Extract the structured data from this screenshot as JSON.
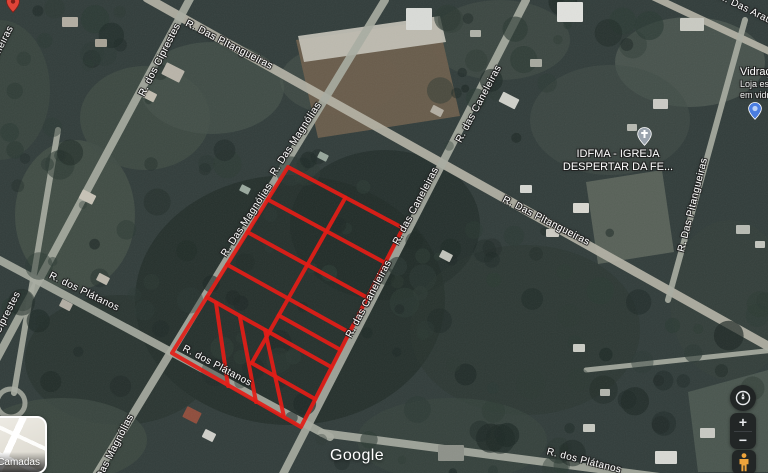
{
  "colors": {
    "parcel_stroke": "#e41d17",
    "road_fill": "#a9ada2",
    "road_fill_light": "#b7b5a8",
    "label_text": "#ffffff",
    "church_pin": "#9aa3ad",
    "store_pin": "#4a7de0",
    "red_marker": "#e04438",
    "pegman": "#eda33b",
    "control_bg": "#1b1d1f"
  },
  "map": {
    "attribution": "Google",
    "road_labels": [
      {
        "text": "R. dos Ciprestes",
        "x": 160,
        "y": 60,
        "rot": -63
      },
      {
        "text": "R. Das Pitangueiras",
        "x": 229,
        "y": 45,
        "rot": 27
      },
      {
        "text": "R. Das Magnólias",
        "x": 296,
        "y": 139,
        "rot": -57
      },
      {
        "text": "R. Das Magnólias",
        "x": 247,
        "y": 220,
        "rot": -57
      },
      {
        "text": "R. das Caneleiras",
        "x": 479,
        "y": 104,
        "rot": -62
      },
      {
        "text": "R. das Caneleiras",
        "x": 416,
        "y": 206,
        "rot": -62
      },
      {
        "text": "R. das Caneleiras",
        "x": 369,
        "y": 299,
        "rot": -62
      },
      {
        "text": "R. Das Pitangueiras",
        "x": 546,
        "y": 221,
        "rot": 27
      },
      {
        "text": "R. Das Pitangueiras",
        "x": 693,
        "y": 205,
        "rot": -76
      },
      {
        "text": "R. Das Araucárias",
        "x": 758,
        "y": 15,
        "rot": 26
      },
      {
        "text": "R. dos Plátanos",
        "x": 84,
        "y": 292,
        "rot": 26
      },
      {
        "text": "R. dos Plátanos",
        "x": 217,
        "y": 366,
        "rot": 28
      },
      {
        "text": "R. dos Plátanos",
        "x": 584,
        "y": 461,
        "rot": 14
      },
      {
        "text": "R. dos Ciprestes",
        "x": 0,
        "y": 328,
        "rot": -63
      },
      {
        "text": "R. Das Magnólias",
        "x": 112,
        "y": 453,
        "rot": -63
      },
      {
        "text": "R. Das Palmeiras",
        "x": -8,
        "y": 64,
        "rot": -63
      }
    ],
    "pois": {
      "church": {
        "line1": "IDFMA - IGREJA",
        "line2": "DESPERTAR DA FE...",
        "text_x": 533,
        "text_y": 148,
        "icon_x": 637,
        "icon_y": 127
      },
      "store": {
        "line1": "Vidraçar",
        "line2": "Loja espe",
        "line3": "em vidro",
        "text_x": 740,
        "text_y": 66,
        "icon_x": 748,
        "icon_y": 102
      }
    },
    "red_marker": {
      "x": 6,
      "y": -5
    },
    "roads": [
      {
        "x1": 147,
        "y1": -2,
        "x2": 775,
        "y2": 350,
        "w": 9,
        "light": true
      },
      {
        "x1": 192,
        "y1": -5,
        "x2": -12,
        "y2": 375,
        "w": 8,
        "light": false
      },
      {
        "x1": 385,
        "y1": 0,
        "x2": 90,
        "y2": 485,
        "w": 8,
        "light": false
      },
      {
        "x1": 526,
        "y1": 0,
        "x2": 280,
        "y2": 480,
        "w": 8,
        "light": false
      },
      {
        "x1": -10,
        "y1": 255,
        "x2": 330,
        "y2": 437,
        "w": 8,
        "light": false
      },
      {
        "x1": 322,
        "y1": 433,
        "x2": 775,
        "y2": 492,
        "w": 8,
        "light": false
      },
      {
        "x1": 628,
        "y1": -15,
        "x2": 792,
        "y2": 62,
        "w": 7,
        "light": true
      },
      {
        "x1": 745,
        "y1": 20,
        "x2": 668,
        "y2": 300,
        "w": 6,
        "light": false
      },
      {
        "x1": 586,
        "y1": 370,
        "x2": 775,
        "y2": 350,
        "w": 5,
        "light": false
      },
      {
        "x1": 58,
        "y1": 130,
        "x2": 14,
        "y2": 393,
        "w": 6,
        "light": false
      }
    ],
    "culdesac": {
      "cx": 11,
      "cy": 403,
      "r": 14
    },
    "terrain": {
      "polygons": [
        {
          "pts": [
            [
              296,
              40
            ],
            [
              438,
              20
            ],
            [
              460,
              116
            ],
            [
              318,
              138
            ]
          ],
          "fill": "#6b5e4c",
          "op": 0.95
        },
        {
          "pts": [
            [
              298,
              36
            ],
            [
              440,
              16
            ],
            [
              446,
              42
            ],
            [
              304,
              62
            ]
          ],
          "fill": "#c6c4ba",
          "op": 0.9
        },
        {
          "pts": [
            [
              586,
              182
            ],
            [
              662,
              170
            ],
            [
              674,
              252
            ],
            [
              598,
              264
            ]
          ],
          "fill": "#5c655c",
          "op": 0.9
        },
        {
          "pts": [
            [
              688,
              392
            ],
            [
              768,
              370
            ],
            [
              768,
              472
            ],
            [
              698,
              472
            ]
          ],
          "fill": "#4d5952",
          "op": 0.9
        }
      ],
      "ellipses": [
        [
          290,
          300,
          155,
          125,
          "#232e2b",
          0.8
        ],
        [
          385,
          225,
          95,
          75,
          "#202b28",
          0.65
        ],
        [
          120,
          360,
          95,
          65,
          "#27322d",
          0.6
        ],
        [
          525,
          330,
          115,
          85,
          "#2a3530",
          0.5
        ],
        [
          75,
          215,
          60,
          75,
          "#47534a",
          0.75
        ],
        [
          145,
          118,
          65,
          52,
          "#404c45",
          0.8
        ],
        [
          212,
          88,
          72,
          46,
          "#46524b",
          0.7
        ],
        [
          690,
          62,
          75,
          45,
          "#4d5952",
          0.8
        ],
        [
          62,
          440,
          85,
          42,
          "#3d4a42",
          0.8
        ],
        [
          452,
          440,
          95,
          42,
          "#38443e",
          0.7
        ],
        [
          610,
          120,
          80,
          55,
          "#414d47",
          0.6
        ],
        [
          730,
          300,
          60,
          80,
          "#35413c",
          0.6
        ],
        [
          340,
          80,
          60,
          35,
          "#4a564e",
          0.5
        ],
        [
          500,
          40,
          70,
          40,
          "#434f48",
          0.6
        ],
        [
          0,
          90,
          50,
          70,
          "#3c4841",
          0.7
        ]
      ],
      "buildings": [
        [
          406,
          8,
          26,
          22,
          0,
          "#d9dbd7"
        ],
        [
          557,
          2,
          26,
          20,
          0,
          "#e0e1dd"
        ],
        [
          163,
          66,
          20,
          13,
          27,
          "#b9b4a9"
        ],
        [
          143,
          91,
          13,
          9,
          27,
          "#c2bdb0"
        ],
        [
          500,
          95,
          18,
          11,
          27,
          "#cfd0c9"
        ],
        [
          431,
          107,
          12,
          8,
          27,
          "#b3aea2"
        ],
        [
          520,
          185,
          12,
          8,
          0,
          "#d5d6d1"
        ],
        [
          573,
          203,
          16,
          10,
          0,
          "#d9d8d1"
        ],
        [
          546,
          229,
          13,
          8,
          0,
          "#ceccc4"
        ],
        [
          80,
          192,
          15,
          10,
          27,
          "#c7c2b6"
        ],
        [
          97,
          275,
          12,
          8,
          27,
          "#bcb7ab"
        ],
        [
          60,
          301,
          12,
          8,
          27,
          "#b3aea4"
        ],
        [
          184,
          409,
          16,
          12,
          27,
          "#8f4d3c"
        ],
        [
          203,
          431,
          12,
          9,
          27,
          "#cfcfc9"
        ],
        [
          655,
          451,
          22,
          13,
          0,
          "#d7d8d3"
        ],
        [
          700,
          428,
          15,
          10,
          0,
          "#c8c9c3"
        ],
        [
          736,
          225,
          14,
          9,
          0,
          "#b8bbb3"
        ],
        [
          755,
          241,
          10,
          7,
          0,
          "#c3c5be"
        ],
        [
          530,
          59,
          12,
          8,
          0,
          "#a7a99f"
        ],
        [
          653,
          99,
          15,
          10,
          0,
          "#cbcbc5"
        ],
        [
          627,
          124,
          10,
          7,
          0,
          "#b7b9b1"
        ],
        [
          440,
          252,
          12,
          8,
          27,
          "#c1c2ba"
        ],
        [
          573,
          344,
          12,
          8,
          0,
          "#caccc4"
        ],
        [
          600,
          389,
          10,
          7,
          0,
          "#b3b5ad"
        ],
        [
          62,
          17,
          16,
          10,
          0,
          "#b2ada1"
        ],
        [
          95,
          39,
          12,
          8,
          0,
          "#a7a295"
        ],
        [
          318,
          153,
          10,
          7,
          27,
          "#97a69b"
        ],
        [
          240,
          186,
          10,
          7,
          27,
          "#9aa99e"
        ],
        [
          680,
          18,
          24,
          13,
          0,
          "#c9cac2"
        ],
        [
          470,
          30,
          11,
          7,
          0,
          "#b0b2a8"
        ],
        [
          438,
          445,
          26,
          16,
          0,
          "#8d9189"
        ],
        [
          583,
          424,
          12,
          8,
          0,
          "#c6c8c0"
        ]
      ]
    },
    "parcel_grid": {
      "corners": {
        "A": [
          288,
          167
        ],
        "B": [
          403,
          228
        ],
        "C": [
          301,
          427
        ],
        "D": [
          172,
          353
        ]
      },
      "row_ts": [
        0.175,
        0.35,
        0.525,
        0.7
      ],
      "half_row": {
        "t": 0.6125,
        "s0": 0.5,
        "s1": 1
      },
      "column_divider": {
        "s": 0.5,
        "t0": 0,
        "t1": 0.86
      },
      "lower_right_row": {
        "t": 0.86,
        "s0": 0.5,
        "s1": 1
      },
      "strip_dividers": [
        [
          216,
          303,
          228,
          386
        ],
        [
          240,
          317,
          256,
          402
        ],
        [
          265,
          330,
          284,
          417
        ]
      ],
      "stroke_width": 4
    }
  },
  "controls": {
    "layers": {
      "label": "Camadas"
    },
    "zoom_in": {
      "label": "+"
    },
    "zoom_out": {
      "label": "−"
    }
  }
}
